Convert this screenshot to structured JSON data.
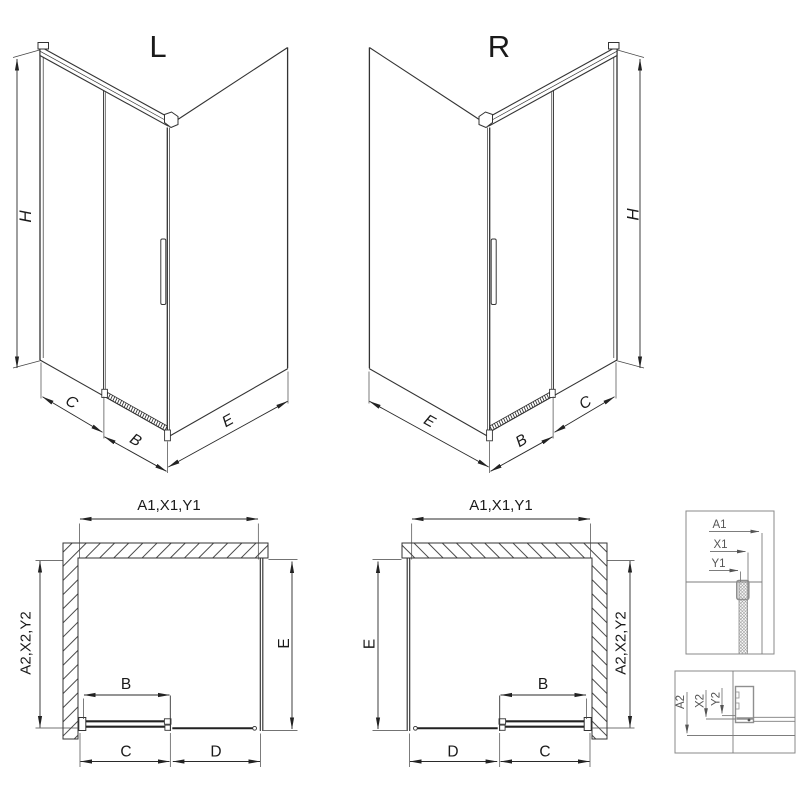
{
  "colors": {
    "background": "#ffffff",
    "line": "#333333",
    "text": "#1a1a1a",
    "detail_line": "#808080"
  },
  "views": {
    "perspective_left": {
      "label": "L",
      "dims": {
        "h": "H",
        "c": "C",
        "b": "B",
        "e": "E"
      }
    },
    "perspective_right": {
      "label": "R",
      "dims": {
        "h": "H",
        "c": "C",
        "b": "B",
        "e": "E"
      }
    },
    "plan_left": {
      "dims": {
        "width": "A1,X1,Y1",
        "depth_left": "A2,X2,Y2",
        "depth_right": "E",
        "door": "B",
        "floor_left": "C",
        "floor_right": "D"
      }
    },
    "plan_right": {
      "dims": {
        "width": "A1,X1,Y1",
        "depth_left": "E",
        "depth_right": "A2,X2,Y2",
        "door": "B",
        "floor_left": "D",
        "floor_right": "C"
      }
    },
    "detail_width": {
      "refs": [
        "A1",
        "X1",
        "Y1"
      ]
    },
    "detail_depth": {
      "refs": [
        "A2",
        "X2",
        "Y2"
      ]
    }
  }
}
